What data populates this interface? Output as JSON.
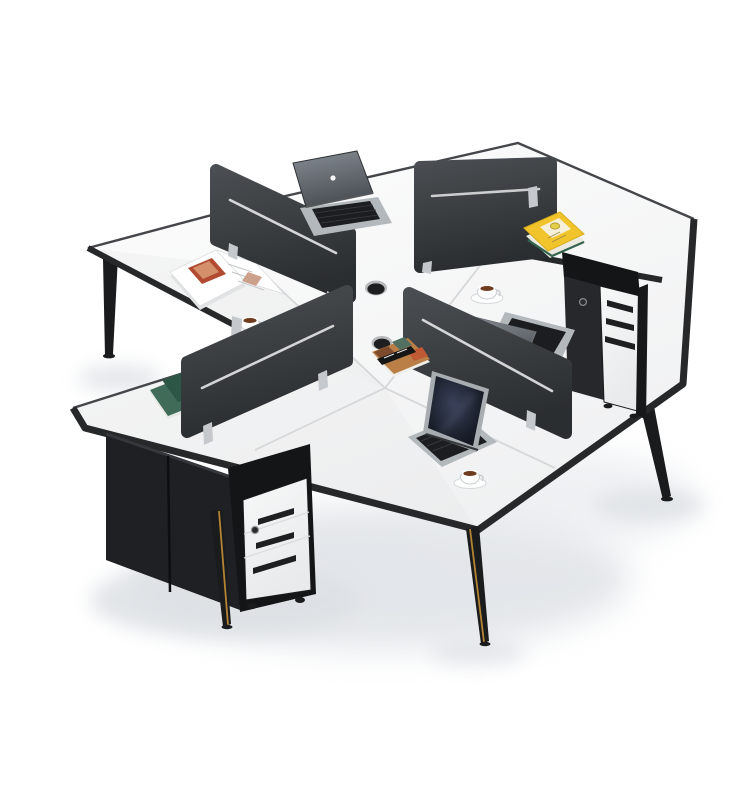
{
  "meta": {
    "title": "4-person white office workstation cluster product photo",
    "background": "#ffffff"
  },
  "colors": {
    "desk_top": "#fafbfb",
    "desk_shade": "#f1f2f3",
    "desk_edge": "#27282a",
    "desk_edge_thin": "#44464a",
    "seam": "#d5d7d9",
    "divider": "#3a3e41",
    "divider_dark": "#2c2f32",
    "divider_slot": "#e4e6e7",
    "clip": "#c5c9cd",
    "leg": "#1a1b1d",
    "leg_gold": "#b28433",
    "cabinet": "#1e2023",
    "pedestal_shell": "#141517",
    "pedestal_front": "#f3f4f5",
    "drawer_slot": "#1e1f21",
    "keyhole": "#2a2b2d",
    "laptop_silver": "#b3b8bd",
    "laptop_back": "#93999f",
    "keys": "#1b1d20",
    "screen_rim": "#a8adb2",
    "galaxy_light": "#39415a",
    "galaxy_dark": "#0b0d12",
    "cup": "#ffffff",
    "cup_line": "#cbced1",
    "coffee": "#6f3c1d",
    "magazine_page": "#ffffff",
    "magazine_red": "#b24a31",
    "magazine_tan": "#d4906b",
    "notebook_light": "#3f6b58",
    "notebook_dark": "#2e5647",
    "book_yellow": "#f2c42b",
    "book_label": "#f6efda",
    "lemon": "#e3cf4a",
    "lemon_edge": "#b89b2e",
    "book_pages": "#ece9e0",
    "book_green_edge": "#356450",
    "collage_base": "#b97f46",
    "collage_dark": "#7d4a2e",
    "collage_teal": "#517062",
    "collage_red": "#c05a35",
    "collage_band": "#161616",
    "grommet_rim": "#b8babc",
    "grommet_hole": "#1d1e20",
    "shadow": "#dde1e5",
    "shadow_soft": "#e8ebee"
  },
  "scene": {
    "items": [
      {
        "name": "desk-cluster",
        "desc": "Four white desks joined in a pinwheel cross, thin black edge banding"
      },
      {
        "name": "divider-panels",
        "desc": "Four dark grey fabric privacy screens with white accent slot and metal clips"
      },
      {
        "name": "macbook-laptop",
        "desc": "Silver open laptop on top desk"
      },
      {
        "name": "silver-laptop",
        "desc": "Silver laptop seen from behind on right desk"
      },
      {
        "name": "galaxy-laptop",
        "desc": "Open laptop facing viewer with dark galaxy wallpaper on bottom desk"
      },
      {
        "name": "open-magazine",
        "desc": "Open magazine on left desk"
      },
      {
        "name": "green-notebooks",
        "desc": "Two green notebooks on lower-left desk"
      },
      {
        "name": "yellow-lemon-book",
        "desc": "Yellow book with lemon cover stacked on green book, right desk"
      },
      {
        "name": "collage-book",
        "desc": "Small collage-cover book near centre grommet"
      },
      {
        "name": "coffee-cups",
        "desc": "Three white cups of coffee on saucers"
      },
      {
        "name": "mobile-pedestals",
        "desc": "Two white 3-drawer mobile pedestals with black shells, lock keyholes and castors"
      },
      {
        "name": "under-desk-cabinets",
        "desc": "Dark under-desk storage cabinets at lower left"
      },
      {
        "name": "tapered-legs",
        "desc": "Black tapered steel legs, two with brass gold stripe"
      },
      {
        "name": "cable-grommets",
        "desc": "Two round black cable grommets near desk centre"
      }
    ]
  }
}
